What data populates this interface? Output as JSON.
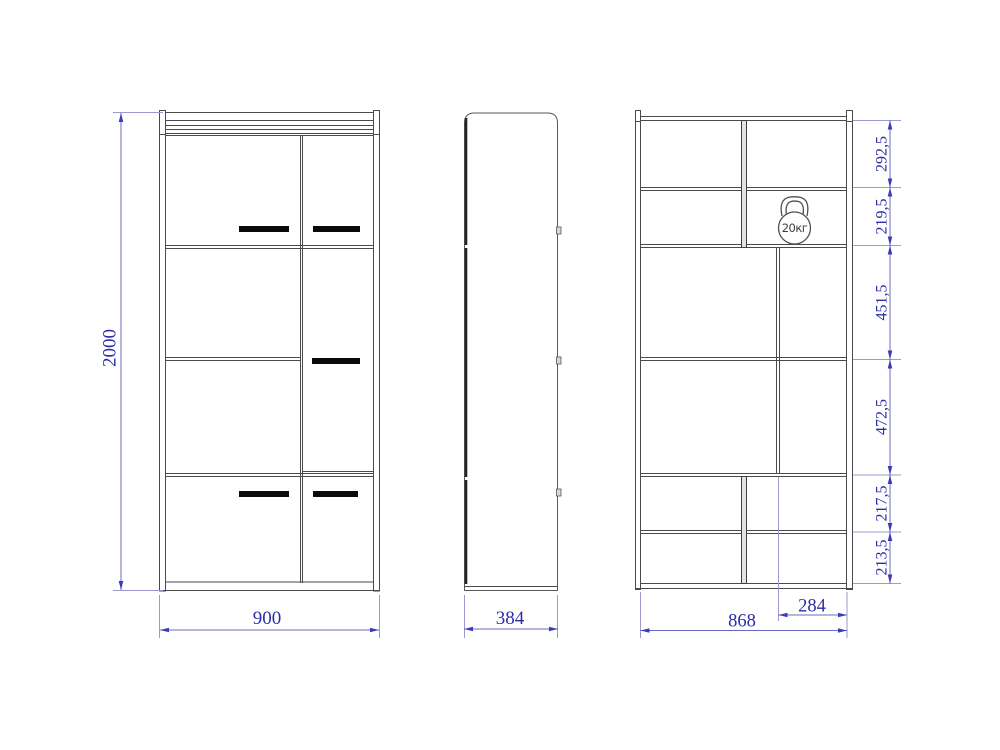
{
  "front_view": {
    "height_mm": "2000",
    "width_mm": "900"
  },
  "side_view": {
    "depth_mm": "384"
  },
  "section_view": {
    "segment_heights_mm": [
      "292,5",
      "219,5",
      "451,5",
      "472,5",
      "217,5",
      "213,5"
    ],
    "inner_width_mm": "868",
    "right_compartment_width_mm": "284",
    "max_shelf_load": "20кг"
  },
  "colors": {
    "outline": "#4a4a4a",
    "dimension_line": "#6b6bbd",
    "dimension_text": "#2c2caa",
    "handle": "#0a0a0a"
  }
}
